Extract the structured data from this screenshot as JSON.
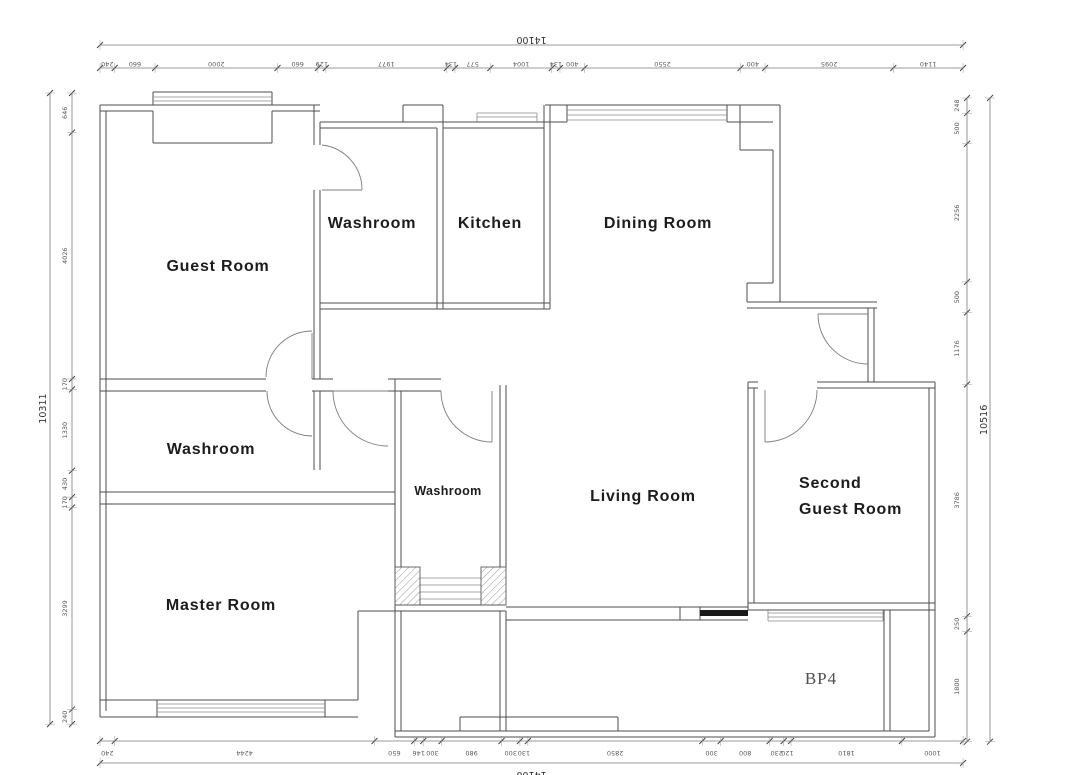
{
  "rooms": {
    "guest_room": "Guest Room",
    "washroom_top": "Washroom",
    "kitchen": "Kitchen",
    "dining_room": "Dining Room",
    "washroom_mid": "Washroom",
    "washroom_center": "Washroom",
    "living_room": "Living Room",
    "second_guest_room_line1": "Second",
    "second_guest_room_line2": "Guest Room",
    "master_room": "Master Room",
    "balcony": "BP4"
  },
  "dimensions": {
    "top": {
      "total": "14100",
      "segments": [
        "240",
        "660",
        "2000",
        "660",
        "129",
        "1977",
        "134",
        "577",
        "1004",
        "134",
        "400",
        "2550",
        "400",
        "2095",
        "1140"
      ]
    },
    "bottom": {
      "total": "14100",
      "segments": [
        "240",
        "4244",
        "650",
        "146",
        "300",
        "980",
        "300",
        "130",
        "2850",
        "300",
        "800",
        "230",
        "120",
        "1810",
        "1000"
      ]
    },
    "left": {
      "total": "10311",
      "segments": [
        "646",
        "4026",
        "170",
        "1330",
        "430",
        "170",
        "3299",
        "240"
      ]
    },
    "right": {
      "total": "10516",
      "segments": [
        "248",
        "500",
        "2256",
        "500",
        "1176",
        "3786",
        "250",
        "1800"
      ]
    }
  },
  "colors": {
    "background": "#ffffff",
    "wall_line": "#4d4d4d",
    "dim_text": "#5a5a5a",
    "room_text": "#1c1c1c",
    "balcony_text": "#4f4f4f",
    "door_sill": "#1a1a1a"
  }
}
